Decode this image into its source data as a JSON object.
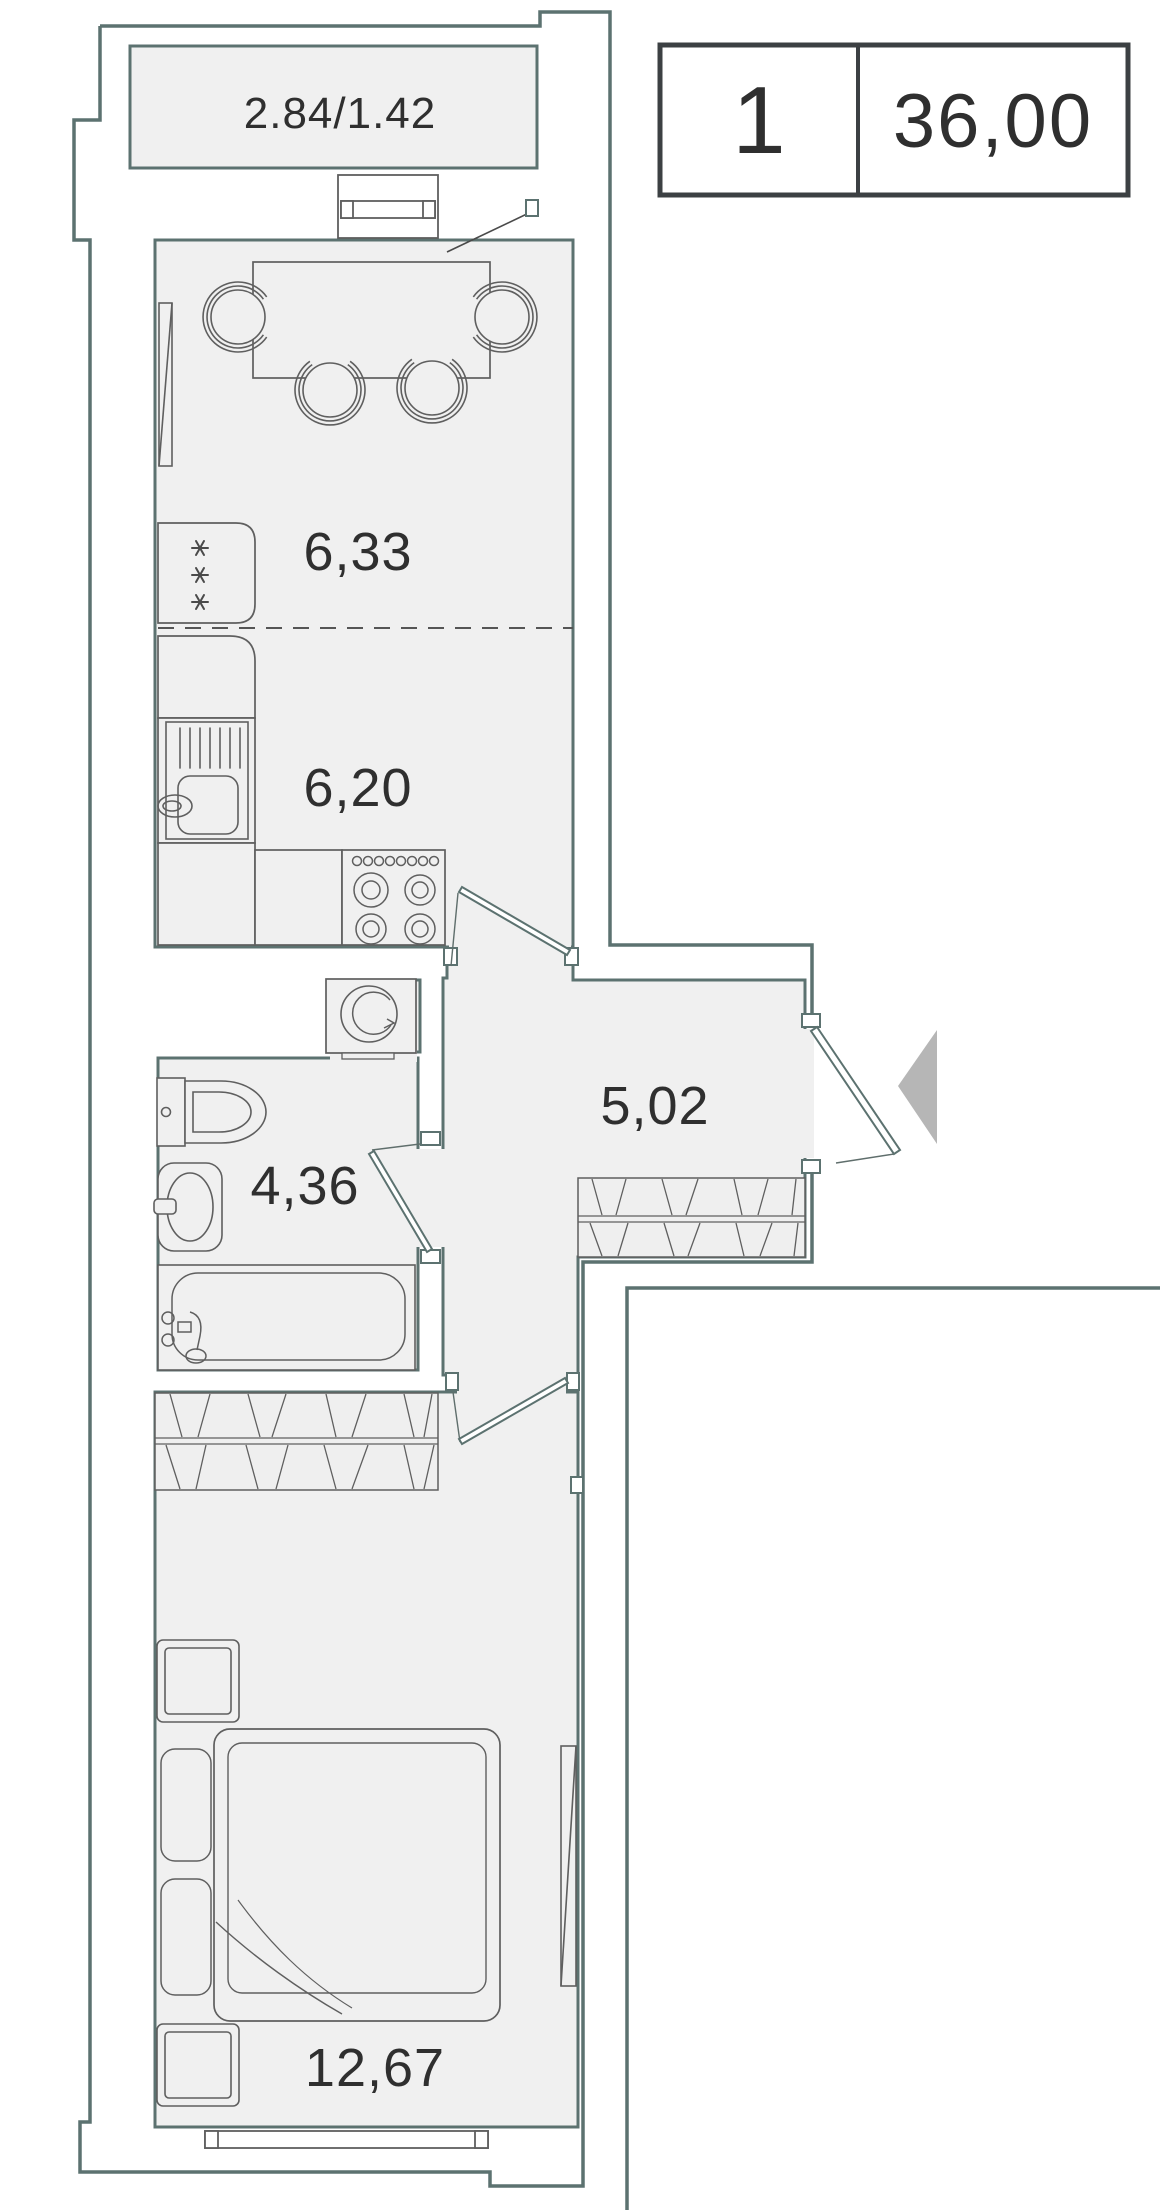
{
  "title": "one-room apartment floor plan",
  "legend": {
    "rooms_count": "1",
    "total_area": "36,00"
  },
  "rooms": {
    "balcony": {
      "label": "2.84/1.42"
    },
    "living": {
      "label": "6,33"
    },
    "kitchen": {
      "label": "6,20"
    },
    "hallway": {
      "label": "5,02"
    },
    "bathroom": {
      "label": "4,36"
    },
    "bedroom": {
      "label": "12,67"
    }
  },
  "colors": {
    "wall_line": "#5c7270",
    "furniture_line": "#5f5f5f",
    "floor_fill": "#f0f0f0",
    "label_text": "#2f2f2f",
    "legend_border": "#3c4043",
    "entry_arrow": "#b6b6b6"
  },
  "icons": {
    "dining_set": "table with four chairs",
    "fridge": "refrigerator with three snowflakes",
    "sink": "kitchen sink with drainer",
    "stove": "four-burner stove",
    "washing_machine": "washing machine",
    "toilet": "toilet",
    "washbasin": "washbasin",
    "bathtub": "bathtub",
    "wardrobe": "hatched wardrobe",
    "bed": "double bed with pillows",
    "nightstand": "nightstand",
    "entry_arrow": "entrance direction arrow"
  }
}
